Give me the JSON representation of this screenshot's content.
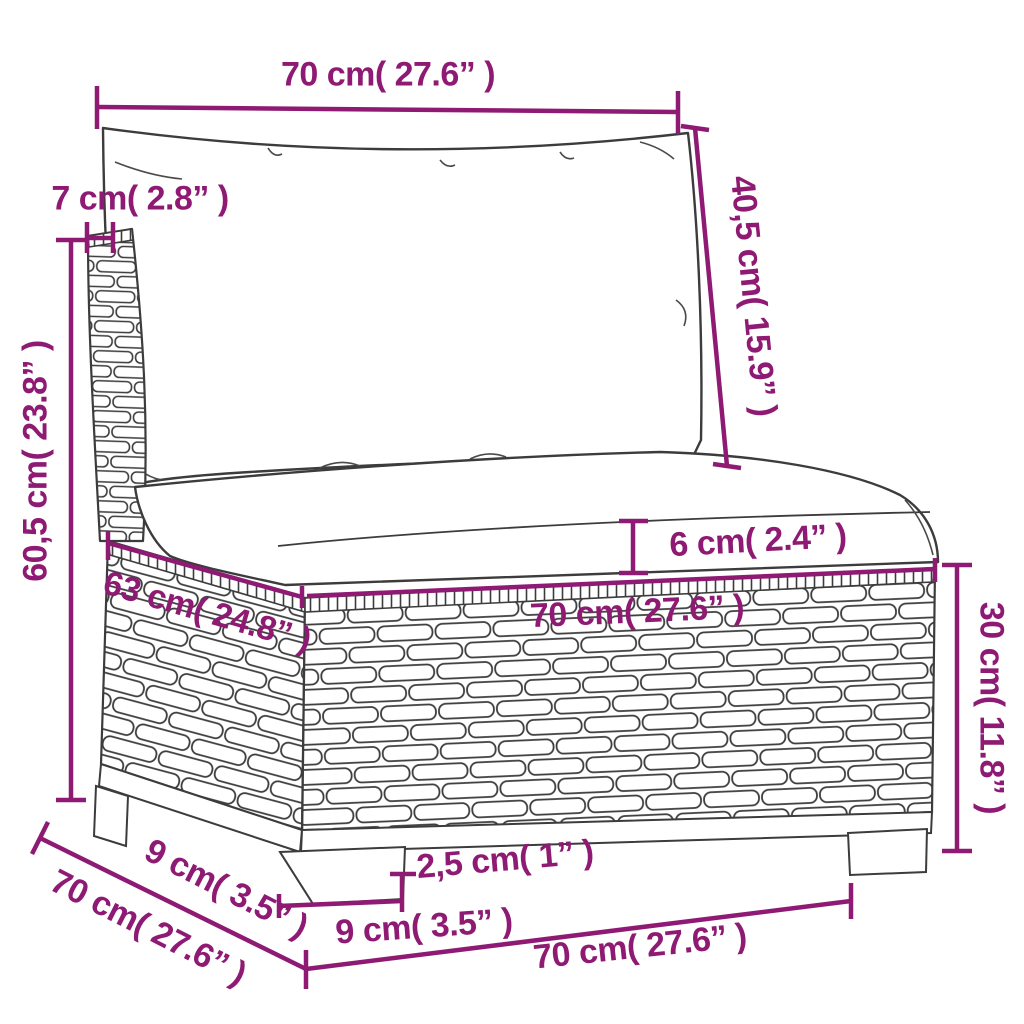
{
  "diagram": {
    "subject": "poly-rattan garden sofa middle section with back and seat cushions",
    "view": "three-quarter front-left product dimension drawing",
    "background_color": "#ffffff"
  },
  "style": {
    "dimension_color": "#8e1a73",
    "outline_color": "#3c3c3c",
    "fill_color": "#ffffff"
  },
  "dimensions": [
    {
      "id": "back-cushion-width",
      "label": "70 cm( 27.6” )",
      "cm": "70",
      "inch": "27.6"
    },
    {
      "id": "back-frame-thickness",
      "label": "7 cm( 2.8” )",
      "cm": "7",
      "inch": "2.8"
    },
    {
      "id": "back-height",
      "label": "60,5 cm( 23.8” )",
      "cm": "60,5",
      "inch": "23.8"
    },
    {
      "id": "back-cushion-height",
      "label": "40,5 cm( 15.9” )",
      "cm": "40,5",
      "inch": "15.9"
    },
    {
      "id": "seat-cushion-thickness",
      "label": "6 cm( 2.4” )",
      "cm": "6",
      "inch": "2.4"
    },
    {
      "id": "seat-depth",
      "label": "63 cm( 24.8” )",
      "cm": "63",
      "inch": "24.8"
    },
    {
      "id": "seat-width",
      "label": "70 cm( 27.6” )",
      "cm": "70",
      "inch": "27.6"
    },
    {
      "id": "base-height",
      "label": "30 cm( 11.8” )",
      "cm": "30",
      "inch": "11.8"
    },
    {
      "id": "leg-height",
      "label": "2,5 cm( 1” )",
      "cm": "2,5",
      "inch": "1"
    },
    {
      "id": "front-leg-width",
      "label": "9 cm( 3.5” )",
      "cm": "9",
      "inch": "3.5"
    },
    {
      "id": "side-leg-depth",
      "label": "9 cm( 3.5” )",
      "cm": "9",
      "inch": "3.5"
    },
    {
      "id": "overall-depth",
      "label": "70 cm( 27.6” )",
      "cm": "70",
      "inch": "27.6"
    },
    {
      "id": "overall-width",
      "label": "70 cm( 27.6” )",
      "cm": "70",
      "inch": "27.6"
    }
  ]
}
